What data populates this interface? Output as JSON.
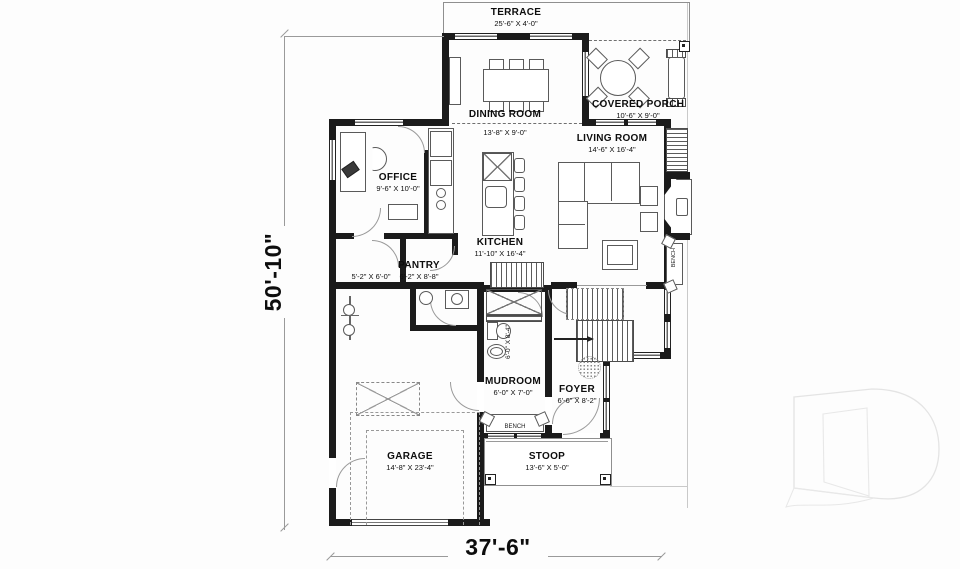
{
  "colors": {
    "wall": "#1b1b1b",
    "furniture_line": "#5a5a5a",
    "dimension_line": "#9a9a9a",
    "watermark": "#e4e4e4"
  },
  "overall_dimensions": {
    "width_label": "37'-6\"",
    "height_label": "50'-10\""
  },
  "rooms": {
    "terrace": {
      "name": "TERRACE",
      "dims": "25'-6\" X 4'-0\""
    },
    "dining_room": {
      "name": "DINING ROOM",
      "dims": "13'-8\" X 9'-0\""
    },
    "covered_porch": {
      "name": "COVERED PORCH",
      "dims": "10'-6\" X 9'-0\""
    },
    "living_room": {
      "name": "LIVING ROOM",
      "dims": "14'-6\" X 16'-4\""
    },
    "office": {
      "name": "OFFICE",
      "dims": "9'-6\" X 10'-0\""
    },
    "kitchen": {
      "name": "KITCHEN",
      "dims": "11'-10\" X 16'-4\""
    },
    "pantry": {
      "name": "PANTRY",
      "dims": "6'-2\" X 8'-8\""
    },
    "closet": {
      "name": "",
      "dims": "5'-2\" X 6'-0\""
    },
    "bathroom": {
      "name": "",
      "dims": "6'-0\" X 8'-4\""
    },
    "mudroom": {
      "name": "MUDROOM",
      "dims": "6'-0\" X 7'-0\""
    },
    "foyer": {
      "name": "FOYER",
      "dims": "6'-6\" X 8'-2\""
    },
    "garage": {
      "name": "GARAGE",
      "dims": "14'-8\" X 23'-4\""
    },
    "stoop": {
      "name": "STOOP",
      "dims": "13'-6\" X 5'-0\""
    }
  },
  "fixtures": {
    "bench_living": "BENCH",
    "bench_mudroom": "BENCH"
  }
}
